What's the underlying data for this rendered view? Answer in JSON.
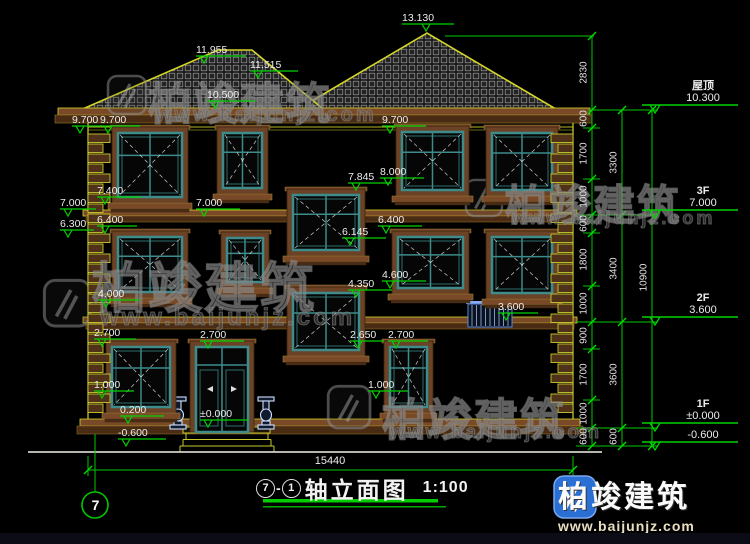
{
  "drawing": {
    "title_axis_start": "7",
    "title_axis_sep": "-",
    "title_axis_end": "1",
    "title_text": "轴立面图",
    "title_scale": "1:100",
    "width_dimension": "15440",
    "axis_bubble": "7"
  },
  "floor_markers": [
    {
      "label": "屋顶",
      "value": "10.300",
      "y": 110
    },
    {
      "label": "3F",
      "value": "7.000",
      "y": 215
    },
    {
      "label": "2F",
      "value": "3.600",
      "y": 322
    },
    {
      "label": "1F",
      "value": "±0.000",
      "y": 428
    },
    {
      "label": "",
      "value": "-0.600",
      "y": 445
    }
  ],
  "elevation_markers": [
    {
      "t": "13.130",
      "x": 402,
      "y": 13,
      "w": 52,
      "tx": 20
    },
    {
      "t": "11.955",
      "x": 196,
      "y": 45,
      "w": 50,
      "tx": 4
    },
    {
      "t": "11.515",
      "x": 250,
      "y": 60,
      "w": 48,
      "tx": 4
    },
    {
      "t": "10.500",
      "x": 207,
      "y": 90,
      "w": 48,
      "tx": 4
    },
    {
      "t": "9.700",
      "x": 72,
      "y": 115,
      "w": 30,
      "tx": 4
    },
    {
      "t": "9.700",
      "x": 100,
      "y": 115,
      "w": 40,
      "tx": 4
    },
    {
      "t": "9.700",
      "x": 382,
      "y": 115,
      "w": 44,
      "tx": 4
    },
    {
      "t": "8.000",
      "x": 380,
      "y": 167,
      "w": 44,
      "tx": 4
    },
    {
      "t": "7.845",
      "x": 348,
      "y": 172,
      "w": 44,
      "tx": 4
    },
    {
      "t": "7.400",
      "x": 97,
      "y": 186,
      "w": 44,
      "tx": 4
    },
    {
      "t": "7.000",
      "x": 60,
      "y": 198,
      "w": 36,
      "tx": 4
    },
    {
      "t": "7.000",
      "x": 196,
      "y": 198,
      "w": 44,
      "tx": 4
    },
    {
      "t": "6.400",
      "x": 97,
      "y": 215,
      "w": 40,
      "tx": 4
    },
    {
      "t": "6.300",
      "x": 60,
      "y": 219,
      "w": 34,
      "tx": 4
    },
    {
      "t": "6.400",
      "x": 378,
      "y": 215,
      "w": 44,
      "tx": 4
    },
    {
      "t": "6.145",
      "x": 342,
      "y": 227,
      "w": 44,
      "tx": 4
    },
    {
      "t": "4.600",
      "x": 382,
      "y": 270,
      "w": 44,
      "tx": 4
    },
    {
      "t": "4.350",
      "x": 348,
      "y": 279,
      "w": 44,
      "tx": 4
    },
    {
      "t": "4.000",
      "x": 98,
      "y": 289,
      "w": 42,
      "tx": 4
    },
    {
      "t": "3.600",
      "x": 498,
      "y": 302,
      "w": 40,
      "tx": 4
    },
    {
      "t": "2.700",
      "x": 94,
      "y": 328,
      "w": 42,
      "tx": 4
    },
    {
      "t": "2.700",
      "x": 200,
      "y": 330,
      "w": 44,
      "tx": 4
    },
    {
      "t": "2.650",
      "x": 350,
      "y": 330,
      "w": 34,
      "tx": 4
    },
    {
      "t": "2.700",
      "x": 388,
      "y": 330,
      "w": 40,
      "tx": 4
    },
    {
      "t": "1.000",
      "x": 94,
      "y": 380,
      "w": 40,
      "tx": 4
    },
    {
      "t": "1.000",
      "x": 368,
      "y": 380,
      "w": 40,
      "tx": 4
    },
    {
      "t": "0.200",
      "x": 120,
      "y": 405,
      "w": 44,
      "tx": 4
    },
    {
      "t": "±0.000",
      "x": 200,
      "y": 409,
      "w": 48,
      "tx": 4
    },
    {
      "t": "-0.600",
      "x": 118,
      "y": 428,
      "w": 48,
      "tx": 4
    }
  ],
  "dim_chains": {
    "inner": {
      "x": 592,
      "labels": [
        {
          "v": "2830",
          "y": 73
        },
        {
          "v": "600",
          "y": 119
        },
        {
          "v": "1700",
          "y": 154
        },
        {
          "v": "1000",
          "y": 197
        },
        {
          "v": "600",
          "y": 224
        },
        {
          "v": "1800",
          "y": 260
        },
        {
          "v": "1000",
          "y": 304
        },
        {
          "v": "900",
          "y": 336
        },
        {
          "v": "1700",
          "y": 375
        },
        {
          "v": "1000",
          "y": 414
        },
        {
          "v": "600",
          "y": 437
        }
      ]
    },
    "middle": {
      "x": 622,
      "labels": [
        {
          "v": "3300",
          "y": 163
        },
        {
          "v": "3400",
          "y": 269
        },
        {
          "v": "3600",
          "y": 375
        },
        {
          "v": "600",
          "y": 437
        }
      ]
    },
    "outer": {
      "x": 652,
      "labels": [
        {
          "v": "10900",
          "y": 278
        }
      ]
    }
  },
  "watermark": {
    "text": "柏竣建筑",
    "url": "www.baijunjz.com"
  },
  "watermark_instances": [
    {
      "x": 148,
      "y": 68,
      "size": 44,
      "ux": 156,
      "uy": 104,
      "usize": 20
    },
    {
      "x": 505,
      "y": 172,
      "size": 42,
      "ux": 512,
      "uy": 208,
      "usize": 18
    },
    {
      "x": 92,
      "y": 244,
      "size": 54,
      "ux": 100,
      "uy": 304,
      "usize": 24
    },
    {
      "x": 382,
      "y": 384,
      "size": 44,
      "ux": 390,
      "uy": 422,
      "usize": 19
    }
  ],
  "logo": {
    "text": "柏竣建筑",
    "url": "www.baijunjz.com"
  },
  "colors": {
    "background": "#000000",
    "cad_green": "#00c800",
    "cad_yellow": "#c9c930",
    "trim_brown": "#6b4226",
    "frame_teal": "#3d8b8b",
    "text_white": "#ececec",
    "watermark_gray": "#8a8a8a",
    "logo_blue": "#2a6fd4",
    "railing_blue": "#7da2e0"
  }
}
